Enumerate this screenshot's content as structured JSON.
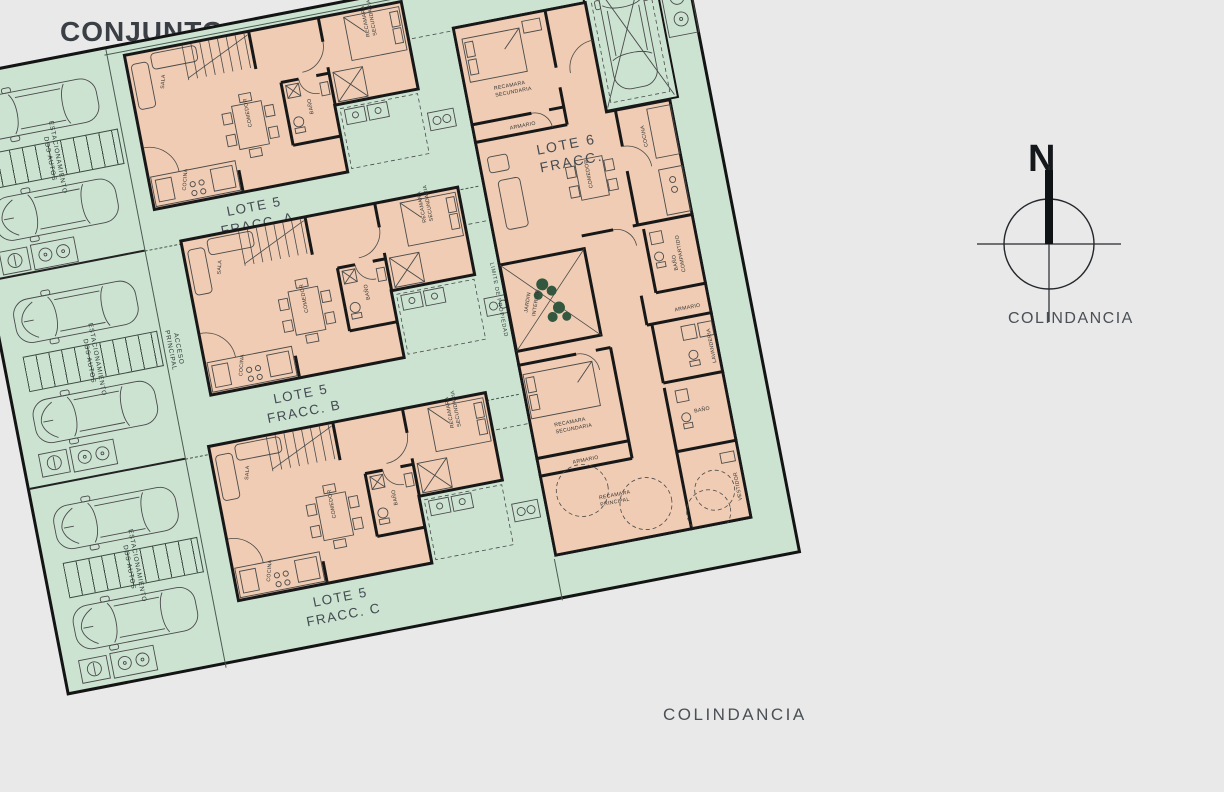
{
  "title": "CONJUNTO CHAPULTEPEC",
  "streets": {
    "top": "CALLE",
    "left": "CALLE",
    "right": "COLINDANCIA",
    "bottom": "COLINDANCIA"
  },
  "north": {
    "label": "N"
  },
  "lots": {
    "a": {
      "line1": "LOTE 5",
      "line2": "FRACC. A"
    },
    "b": {
      "line1": "LOTE 5",
      "line2": "FRACC. B"
    },
    "c": {
      "line1": "LOTE 5",
      "line2": "FRACC. C"
    },
    "d": {
      "line1": "LOTE 6",
      "line2": "FRACC."
    }
  },
  "parking": {
    "line1": "ESTACIONAMIENTO",
    "line2": "DOS AUTOS"
  },
  "annotations": {
    "acceso_line1": "ACCESO",
    "acceso_line2": "PRINCIPAL",
    "limite": "LIMITE DE PROPIEDAD"
  },
  "rooms_lote5": {
    "sala": "SALA",
    "comedor": "COMEDOR",
    "cocina": "COCINA",
    "bano": "BAÑO",
    "recamara_l1": "RECAMARA",
    "recamara_l2": "SECUNDARIA"
  },
  "rooms_lote6": {
    "recamara_sec_l1": "RECAMARA",
    "recamara_sec_l2": "SECUNDARIA",
    "armario": "ARMARIO",
    "comedor": "COMEDOR",
    "cocina": "COCINA",
    "jardin_l1": "JARDIN",
    "jardin_l2": "INTERIOR",
    "bano_comp_l1": "BAÑO",
    "bano_comp_l2": "COMPARTIDO",
    "lavanderia": "LAVANDERIA",
    "recamara_ppal_l1": "RECAMARA",
    "recamara_ppal_l2": "PRINCIPAL",
    "bano": "BAÑO",
    "vestidor": "VESTIDOR"
  },
  "colors": {
    "site_green": "#cce3d2",
    "building_peach": "#efccb3",
    "wall_black": "#181818",
    "background": "#e9e9ea"
  }
}
